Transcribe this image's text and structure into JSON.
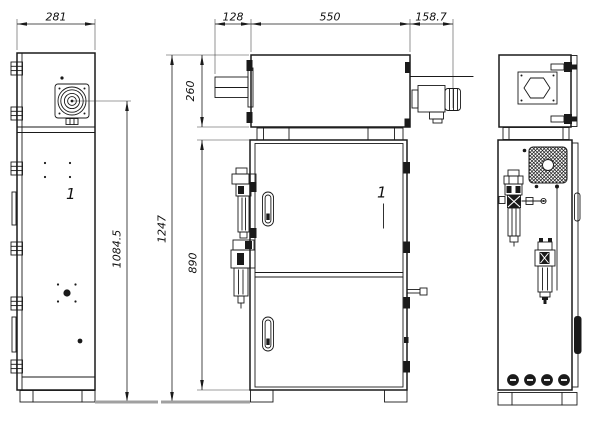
{
  "drawing": {
    "dimensions": {
      "side_width": "281",
      "front_top_offset": "128",
      "front_top_width": "550",
      "front_connector_length": "158.7",
      "front_top_height": "260",
      "side_axis_height": "1084.5",
      "front_total_height": "1247",
      "front_body_height": "890"
    },
    "callout_item": "1",
    "colors": {
      "line": "#1a1a1a",
      "ground": "#a0a0a0",
      "paper": "#ffffff"
    }
  }
}
